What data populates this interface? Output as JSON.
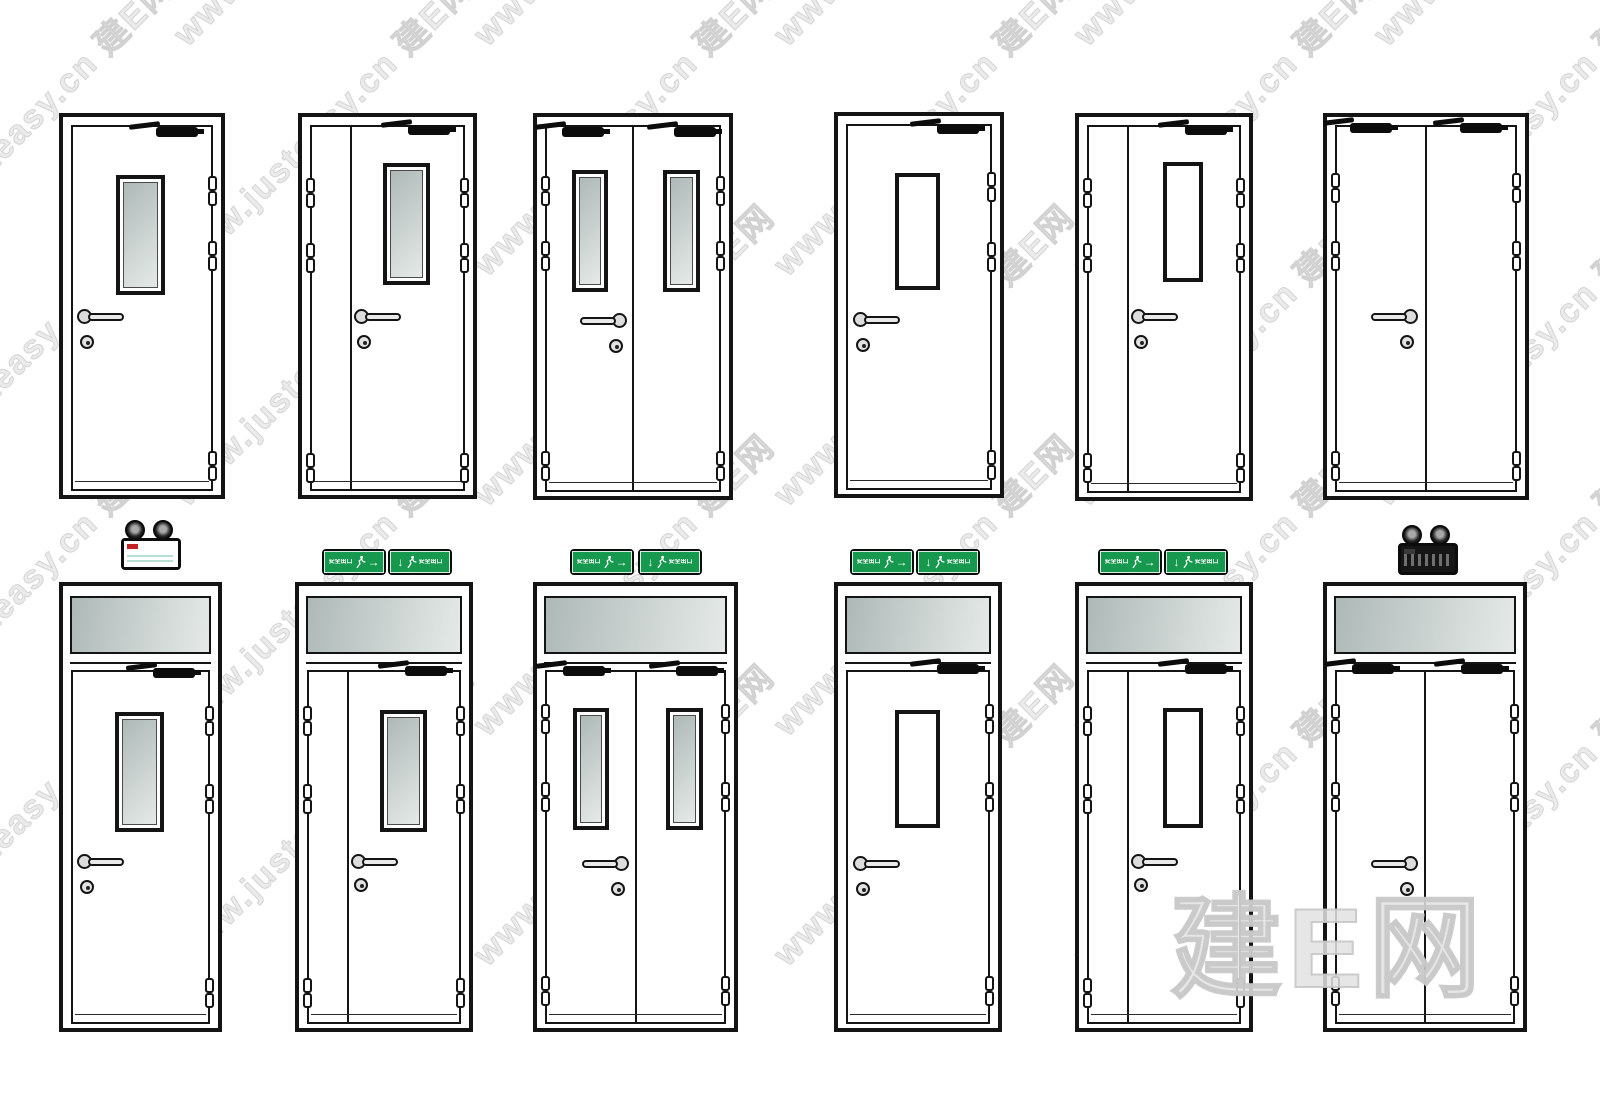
{
  "page": {
    "background": "#ffffff"
  },
  "watermark": {
    "diagonal_text": "www.justeasy.cn 建E网",
    "big_text": "建E网"
  },
  "exit_signs": {
    "label": "安全出口",
    "arrow_right": "→",
    "arrow_down": "↓"
  },
  "colors": {
    "page-bg": "#ffffff",
    "line": "#141414",
    "glass-a": "#aeb9b7",
    "glass-b": "#e5eae8",
    "exit-green": "#16994f",
    "sign-trim": "#d9efe2"
  }
}
